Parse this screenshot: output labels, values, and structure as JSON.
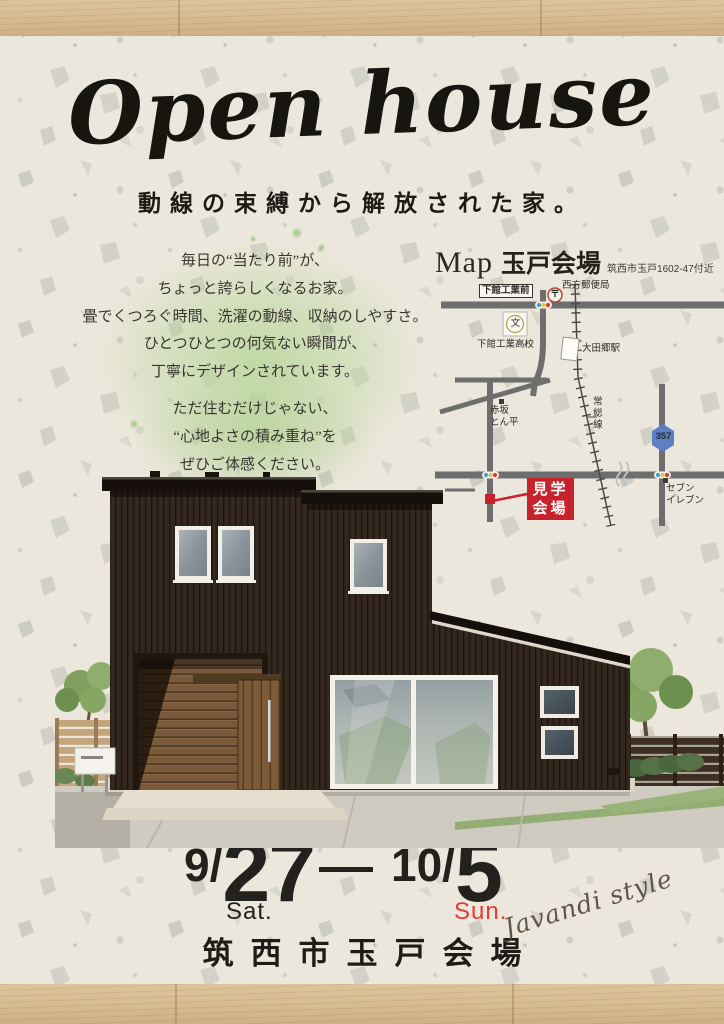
{
  "title": "Open house",
  "subtitle": "動線の束縛から解放された家。",
  "intro": {
    "lines": [
      "毎日の“当たり前”が、",
      "ちょっと誇らしくなるお家。",
      "畳でくつろぐ時間、洗濯の動線、収納のしやすさ。",
      "ひとつひとつの何気ない瞬間が、",
      "丁寧にデザインされています。"
    ]
  },
  "appeal": {
    "lines": [
      "ただ住むだけじゃない、",
      "“心地よさの積み重ね”を",
      "ぜひご体感ください。"
    ]
  },
  "map": {
    "heading": "Map",
    "venue": "玉戸会場",
    "address": "筑西市玉戸1602-47付近",
    "labels": {
      "bus_stop": "下館工業前",
      "post_office": "西方郵便局",
      "post_symbol": "〒",
      "school": "下館工業高校",
      "school_symbol": "文",
      "station": "大田郷駅",
      "rail_line": "常総線",
      "restaurant_line1": "赤坂",
      "restaurant_line2": "とん平",
      "route_number": "357",
      "store_line1": "セブン",
      "store_line2": "イレブン",
      "venue_line1": "見学",
      "venue_line2": "会場"
    }
  },
  "dates": {
    "start": {
      "month": "9/",
      "day": "27",
      "dow": "Sat."
    },
    "end": {
      "month": "10/",
      "day": "5",
      "dow": "Sun."
    }
  },
  "venue_name": "筑西市玉戸会場",
  "signature": "Javandi style",
  "colors": {
    "accent_red": "#c8232c",
    "sun_red": "#e8392f",
    "route_blue": "#5b80c1",
    "green_wash": "#b9d69b",
    "wood": "#d8bc93"
  }
}
